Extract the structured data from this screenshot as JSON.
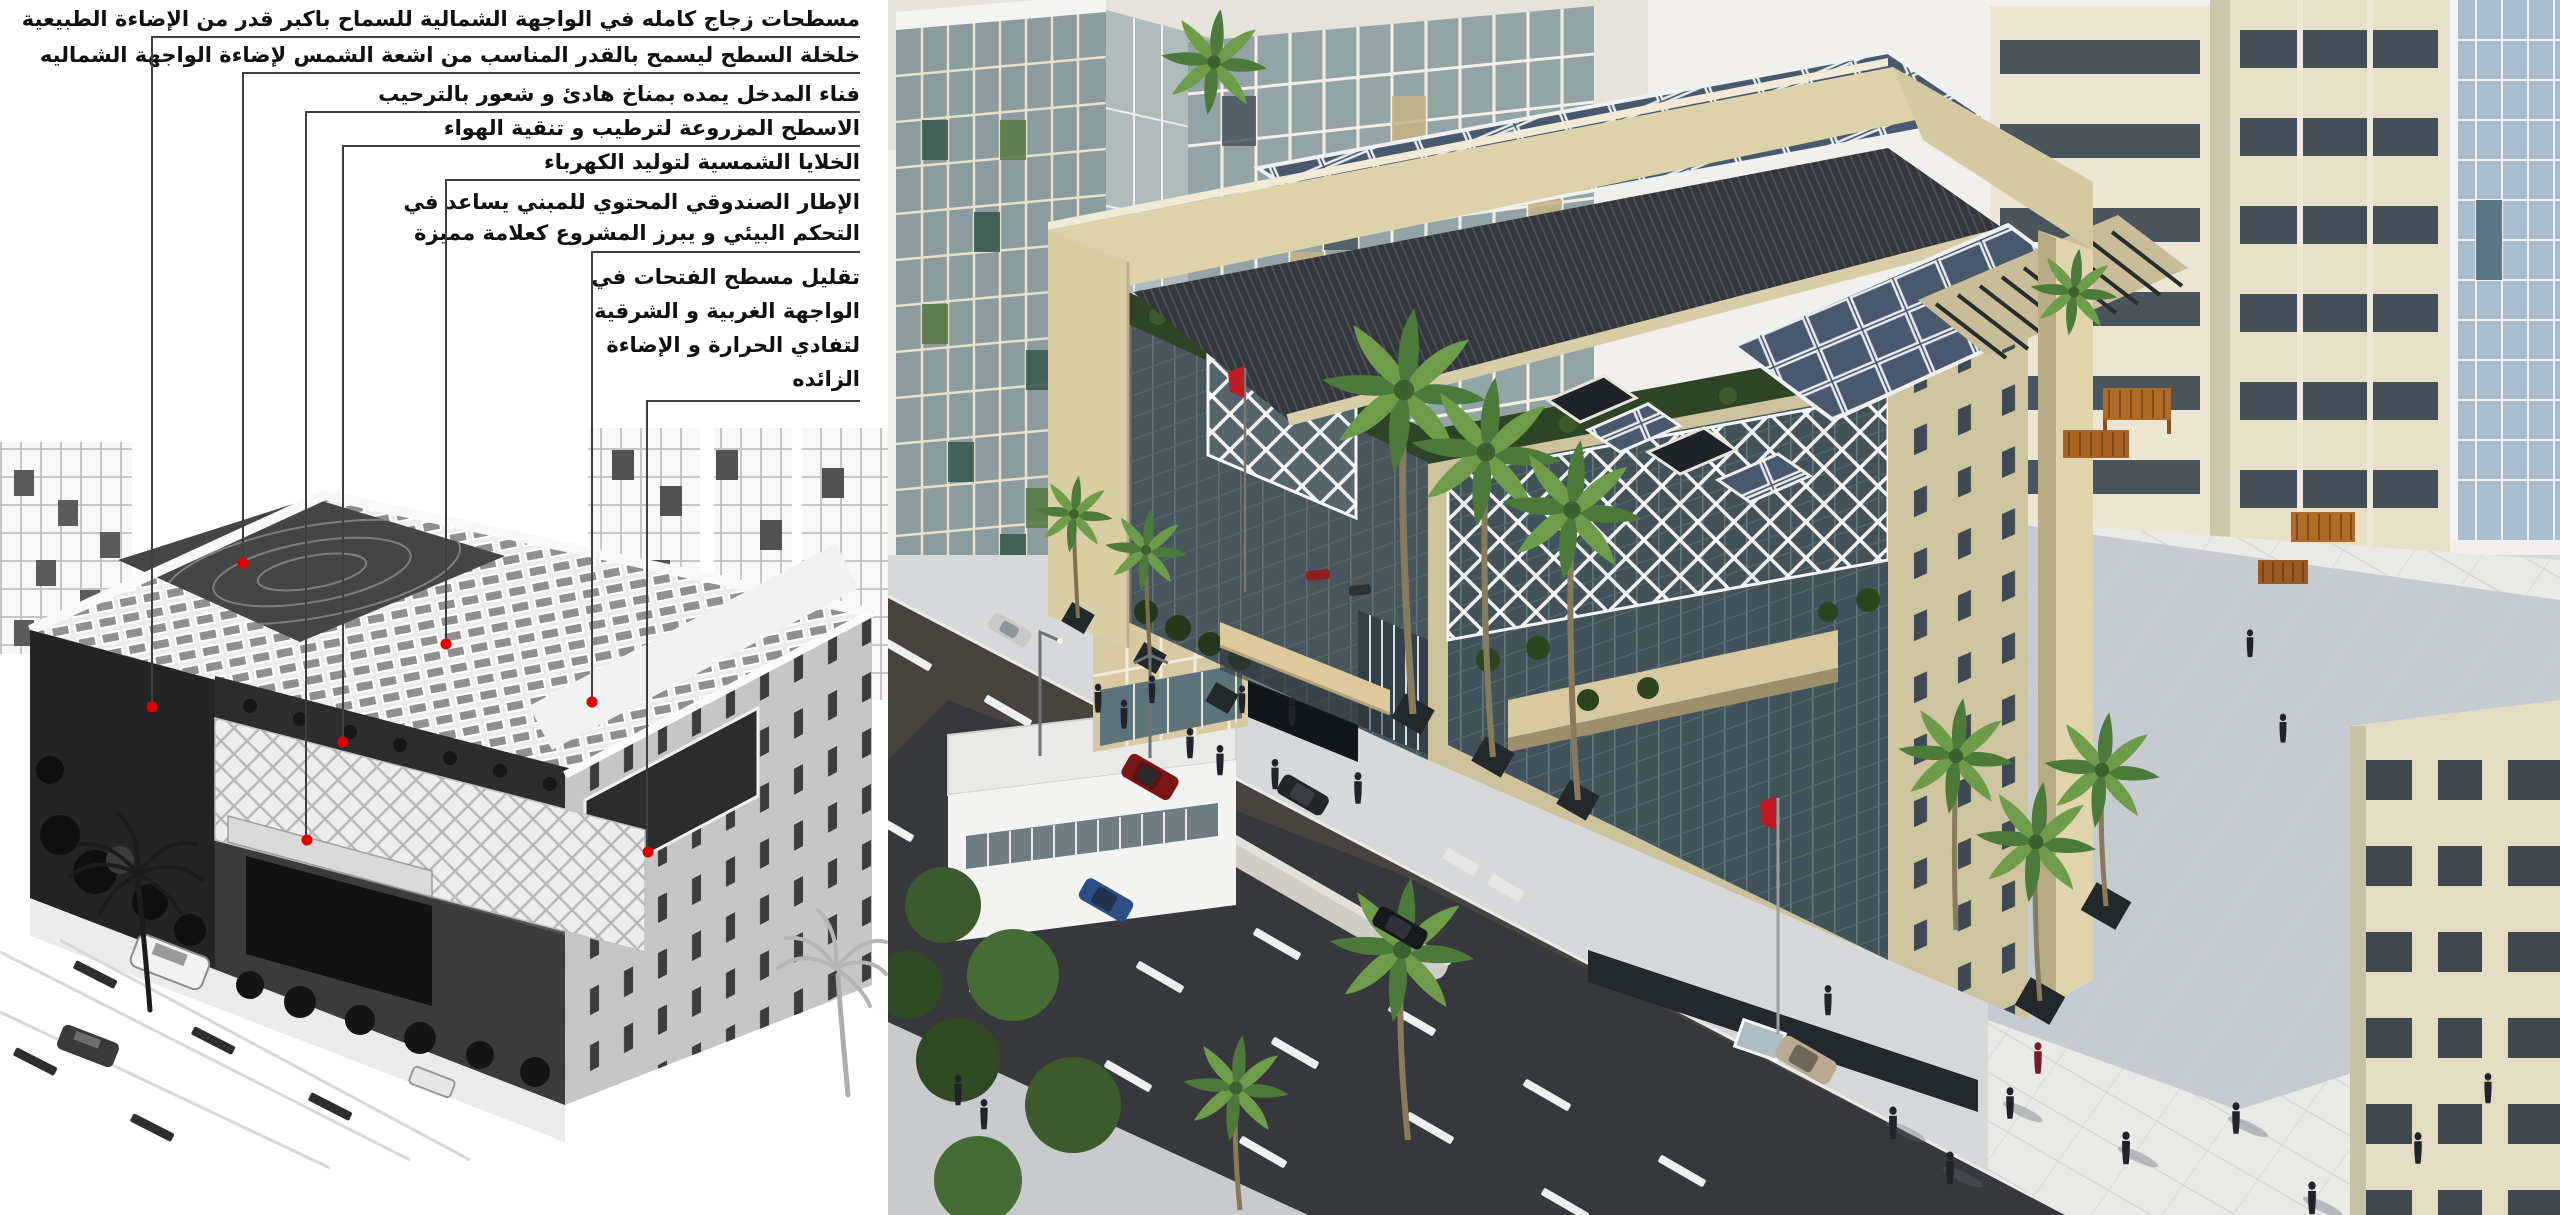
{
  "annotations": {
    "items": [
      {
        "text": "مسطحات زجاج كامله في الواجهة الشمالية للسماح باكبر قدر من الإضاءة الطبيعية",
        "leader": {
          "x": 152,
          "y_under": 37,
          "x_right": 860,
          "dot_x": 152,
          "dot_y": 707
        }
      },
      {
        "text": "خلخلة السطح ليسمح بالقدر المناسب من اشعة الشمس لإضاءة الواجهة الشماليه",
        "leader": {
          "x": 243,
          "y_under": 73,
          "x_right": 860,
          "dot_x": 243,
          "dot_y": 563
        }
      },
      {
        "text": "فناء المدخل يمده بمناخ هادئ و شعور بالترحيب",
        "leader": {
          "x": 306,
          "y_under": 112,
          "x_right": 860,
          "dot_x": 307,
          "dot_y": 840
        }
      },
      {
        "text": "الاسطح المزروعة لترطيب و تنقية الهواء",
        "leader": {
          "x": 343,
          "y_under": 146,
          "x_right": 860,
          "dot_x": 343,
          "dot_y": 742
        }
      },
      {
        "text": "الخلايا الشمسية لتوليد الكهرباء",
        "leader": {
          "x": 446,
          "y_under": 180,
          "x_right": 860,
          "dot_x": 446,
          "dot_y": 644
        }
      },
      {
        "text": "الإطار الصندوقي المحتوي للمبني يساعد في\nالتحكم البيئي و يبرز المشروع كعلامة مميزة",
        "leader": {
          "x": 592,
          "y_under": 252,
          "x_right": 860,
          "dot_x": 592,
          "dot_y": 702
        }
      },
      {
        "text": "تقليل مسطح الفتحات في\nالواجهة الغربية و الشرقية\nلتفادي الحرارة و الإضاءة\nالزائده",
        "leader": {
          "x": 647,
          "y_under": 401,
          "x_right": 860,
          "dot_x": 648,
          "dot_y": 852
        }
      }
    ],
    "style": {
      "text_color": "#111111",
      "line_color": "#3f3f3f",
      "dot_color": "#e10000"
    }
  },
  "left_panel": {
    "content": "grayscale-concept-axonometric-sketch"
  },
  "right_panel": {
    "content": "color-architectural-rendering",
    "colors": {
      "beige_frame": "#dbd0a8",
      "dark_roof": "#34383c",
      "solar_panel": "#46566b",
      "glass": "#46565c",
      "diagrid_white": "#f4f6f6",
      "street": "#3e4045",
      "plaza": "#e9e9e6",
      "greenery": "#44652f",
      "wood_bench": "#b06a28",
      "flag_red": "#c01822",
      "sky": "#f0efec"
    },
    "objects": [
      "main-building",
      "solar-panel-arrays",
      "diagrid-screen",
      "entrance-canopy",
      "green-terraces",
      "street",
      "median-island",
      "lane-dashes",
      "palm-trees",
      "cars",
      "pedestrians",
      "flag-poles",
      "plaza",
      "pergola-benches",
      "background-towers",
      "roof-louvers"
    ]
  }
}
